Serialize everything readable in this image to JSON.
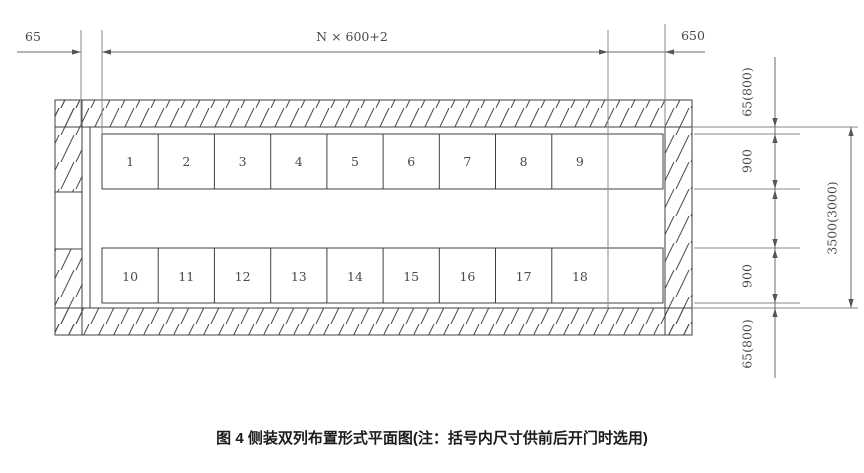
{
  "title": {
    "caption": "图 4  侧装双列布置形式平面图(注：括号内尺寸供前后开门时选用)"
  },
  "dimensions": {
    "top_left_gap": "65",
    "top_span": "N × 600+2",
    "top_right_gap": "650",
    "right_top_clearance": "65(800)",
    "right_row1_depth": "900",
    "right_row2_depth": "900",
    "right_bottom_clearance": "65(800)",
    "right_overall": "3500(3000)"
  },
  "cabinets": {
    "row1_labels": [
      "1",
      "2",
      "3",
      "4",
      "5",
      "6",
      "7",
      "8",
      "9"
    ],
    "row2_labels": [
      "10",
      "11",
      "12",
      "13",
      "14",
      "15",
      "16",
      "17",
      "18"
    ]
  },
  "colors": {
    "line": "#3f3f3f",
    "dimension_line": "#6b6b6b",
    "background": "#ffffff"
  }
}
